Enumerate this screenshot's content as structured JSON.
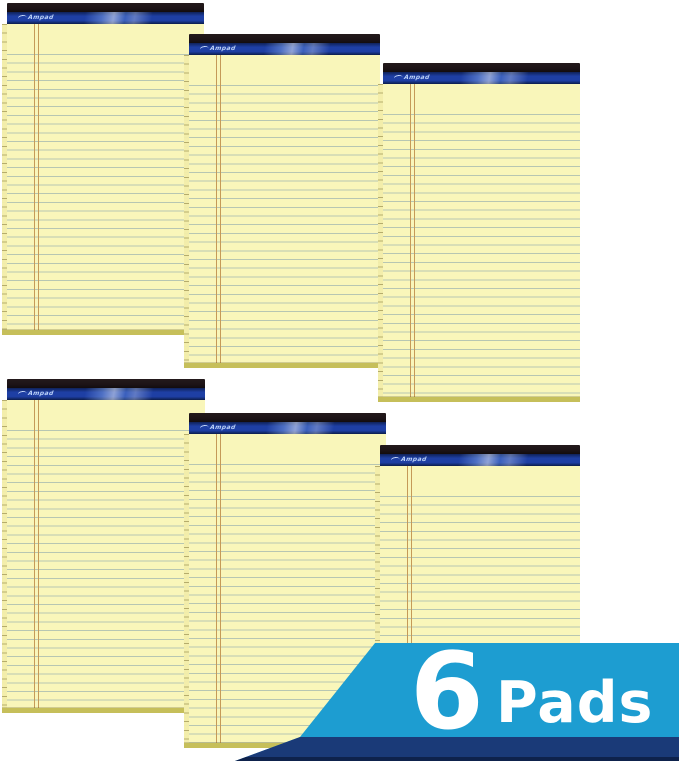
{
  "product": {
    "description": "Stack of six yellow ruled legal pads, staggered in two rows of three",
    "brand": "Ampad",
    "badge": {
      "count": "6",
      "label": "Pads"
    },
    "pads": [
      {
        "brand": "Ampad"
      },
      {
        "brand": "Ampad"
      },
      {
        "brand": "Ampad"
      },
      {
        "brand": "Ampad"
      },
      {
        "brand": "Ampad"
      },
      {
        "brand": "Ampad"
      }
    ],
    "colors": {
      "badge_background": "#1d9dd1",
      "badge_bottom_bar": "#1a3a78",
      "badge_text": "#ffffff",
      "binding_black": "#1d1417",
      "binding_blue": "#1e3fa4",
      "logo_text": "#bcd2f8",
      "paper": "#f9f6ba",
      "rule_line": "#b7c6b2",
      "margin_line": "#c59a58",
      "page_edge": "#c6bf5a"
    }
  }
}
